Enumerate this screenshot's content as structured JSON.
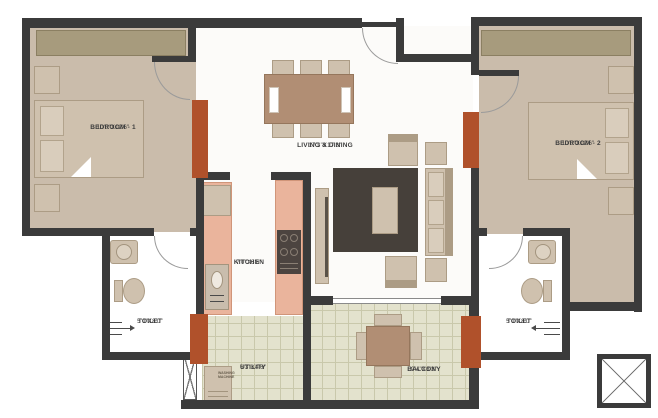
{
  "colors": {
    "wall": "#3b3b3b",
    "accent": "#b0512b",
    "floorTan": "#cabcab",
    "floorWhite": "#fcfbf9",
    "wardrobe": "#a79b7d",
    "wardrobeBorder": "#8b7f62",
    "furn": "#cfc1ae",
    "furnBorder": "#ac9c85",
    "counter": "#eab49c",
    "counterBorder": "#d09579",
    "balconyFloor": "#e3e2cd",
    "balconyGrid": "#c9c8ab",
    "rug": "#46403a",
    "wood": "#b18e74",
    "woodBorder": "#95765c",
    "arc": "#9a9a9a",
    "label": "#3d3d3d"
  },
  "rooms": {
    "bedroom1": {
      "name": "BEDROOM - 1",
      "dims": "10'0\"X12'6\""
    },
    "bedroom2": {
      "name": "BEDROOM - 2",
      "dims": "10'0\"X12'6\""
    },
    "living": {
      "name": "LIVING & DINING",
      "dims": "17'3\"X17'3\""
    },
    "kitchen": {
      "name": "KITCHEN",
      "dims": "7'0\"X8'6\""
    },
    "toilet1": {
      "name": "TOILET",
      "dims": "5'0\"X8'0\""
    },
    "toilet2": {
      "name": "TOILET",
      "dims": "5'0\"X8'0\""
    },
    "utility": {
      "name": "UTILITY",
      "dims": "6'3\"X4'6\""
    },
    "balcony": {
      "name": "BALCONY",
      "dims": "9'4\"X8'3\""
    }
  },
  "labels": {
    "washing_line1": "WASHING",
    "washing_line2": "MACHINE"
  }
}
